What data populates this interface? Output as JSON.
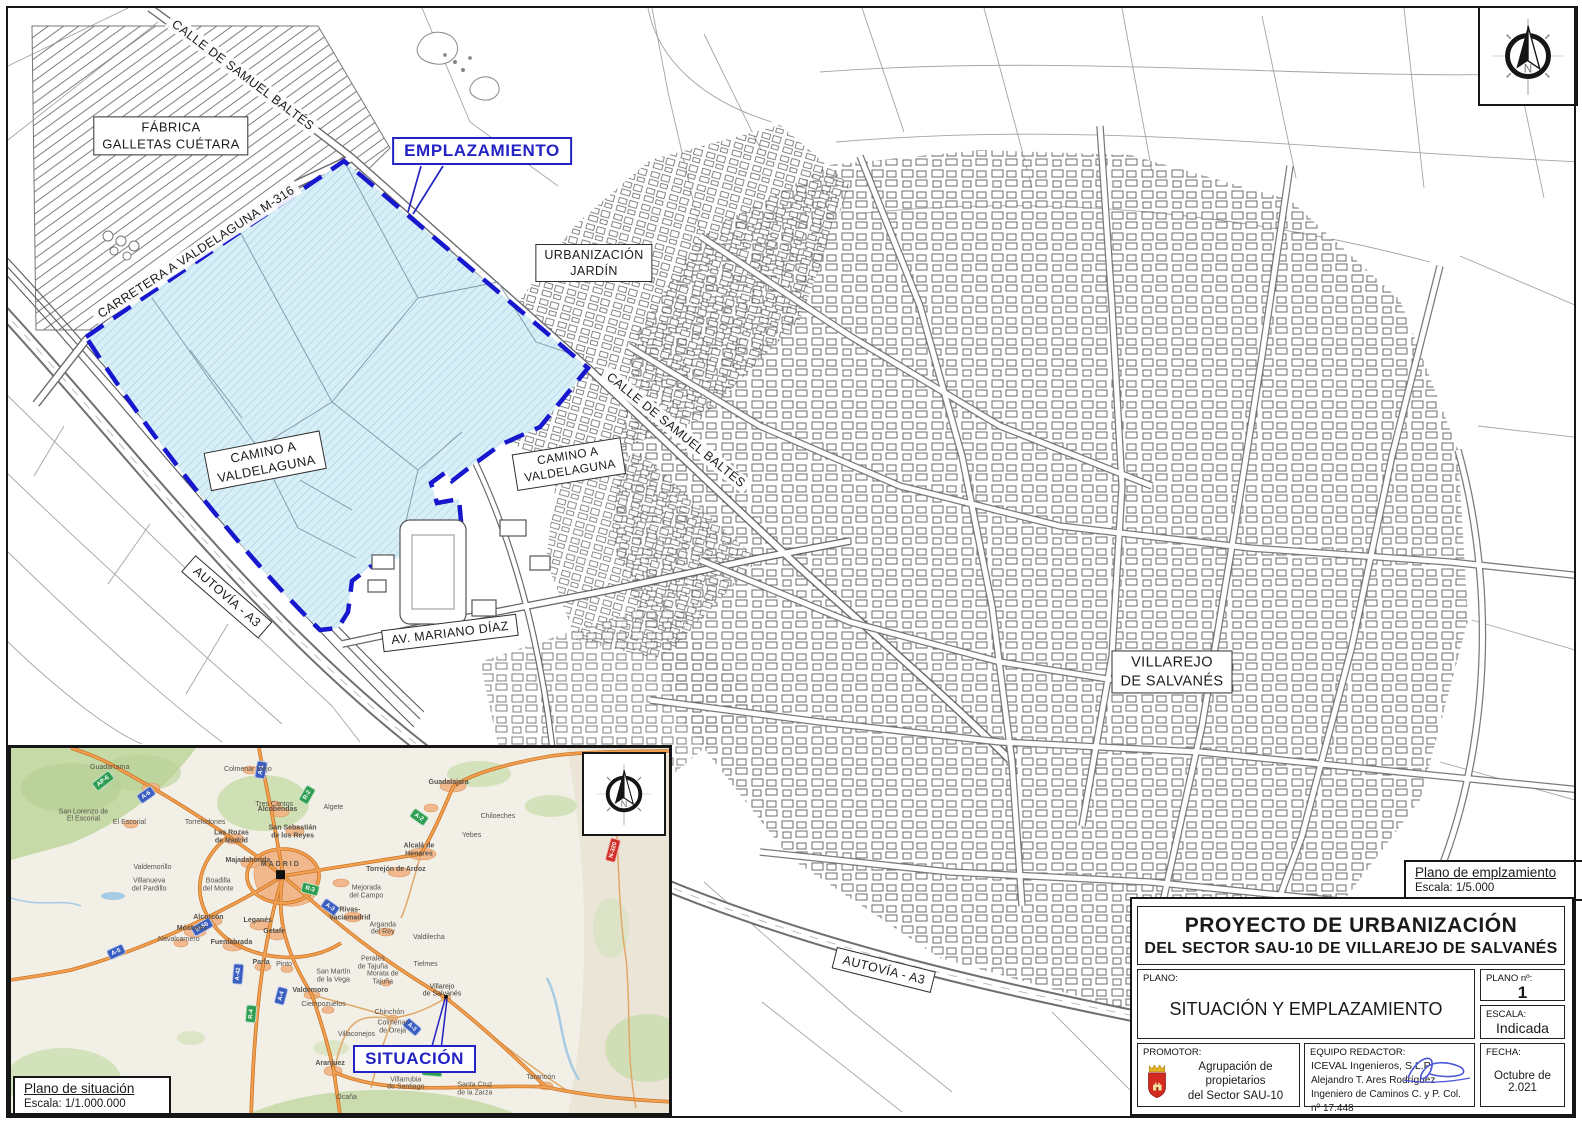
{
  "sheet": {
    "north_letter": "N",
    "emplazamiento_scale_box": {
      "title": "Plano de emplzamiento",
      "scale": "Escala: 1/5.000"
    },
    "situacion_scale_box": {
      "title": "Plano de situación",
      "scale": "Escala: 1/1.000.000"
    }
  },
  "colors": {
    "site_fill": "#d9eff7",
    "site_hatch": "#abd5e6",
    "boundary_blue": "#1717cd",
    "callout_blue": "#2323c4",
    "road_orange": "#e8903c",
    "shield_blue": "#3a5fc0",
    "shield_green": "#2f9e52",
    "shield_red": "#d03028",
    "promoter_shield_red": "#d42a20"
  },
  "main_map": {
    "emplazamiento": {
      "text": "EMPLAZAMIENTO"
    },
    "labels": [
      {
        "id": "fabrica-galletas-cuetara",
        "lines": [
          "FÁBRICA",
          "GALLETAS CUÉTARA"
        ],
        "x": 171,
        "y": 136,
        "rot": 0,
        "boxed": true,
        "fs": 13
      },
      {
        "id": "calle-samuel-baltes-top",
        "lines": [
          "CALLE DE SAMUEL BALTÉS"
        ],
        "x": 243,
        "y": 75,
        "rot": 37,
        "boxed": false,
        "fs": 12.5
      },
      {
        "id": "carretera-valdelaguna-m316",
        "lines": [
          "CARRETERA A VALDELAGUNA M-316"
        ],
        "x": 196,
        "y": 252,
        "rot": -33,
        "boxed": false,
        "fs": 12.5
      },
      {
        "id": "urbanizacion-jardin",
        "lines": [
          "URBANIZACIÓN",
          "JARDÍN"
        ],
        "x": 594,
        "y": 263,
        "rot": 0,
        "boxed": true,
        "fs": 12.5
      },
      {
        "id": "calle-samuel-baltes-mid",
        "lines": [
          "CALLE DE SAMUEL BALTÉS"
        ],
        "x": 676,
        "y": 430,
        "rot": 39,
        "boxed": false,
        "fs": 12.5
      },
      {
        "id": "camino-a-valdelaguna-left",
        "lines": [
          "CAMINO A",
          "VALDELAGUNA"
        ],
        "x": 265,
        "y": 461,
        "rot": -11,
        "boxed": true,
        "fs": 13
      },
      {
        "id": "camino-a-valdelaguna-right",
        "lines": [
          "CAMINO A",
          "VALDELAGUNA"
        ],
        "x": 569,
        "y": 464,
        "rot": -9,
        "boxed": true,
        "fs": 12
      },
      {
        "id": "autovia-a3-left",
        "lines": [
          "AUTOVÍA - A3"
        ],
        "x": 227,
        "y": 597,
        "rot": 41,
        "boxed": true,
        "fs": 12.5
      },
      {
        "id": "av-mariano-diaz",
        "lines": [
          "AV. MARIANO DÍAZ"
        ],
        "x": 450,
        "y": 633,
        "rot": -7,
        "boxed": true,
        "fs": 12.5
      },
      {
        "id": "villarejo-de-salvanes",
        "lines": [
          "VILLAREJO",
          "DE SALVANÉS"
        ],
        "x": 1172,
        "y": 672,
        "rot": 0,
        "boxed": true,
        "fs": 14.5
      },
      {
        "id": "autovia-a3-bottom",
        "lines": [
          "AUTOVÍA - A3"
        ],
        "x": 884,
        "y": 970,
        "rot": 14,
        "boxed": true,
        "fs": 12.5
      }
    ]
  },
  "inset": {
    "situacion": {
      "text": "SITUACIÓN"
    },
    "towns": [
      {
        "n": "MADRID",
        "x": 41,
        "y": 33.5,
        "c": "capital"
      },
      {
        "n": "Guadalajara",
        "x": 66.5,
        "y": 9.5,
        "c": "city"
      },
      {
        "n": "Alcobendas",
        "x": 40.5,
        "y": 17,
        "c": "city"
      },
      {
        "n": "San Sebastián|de los Reyes",
        "x": 42.8,
        "y": 23,
        "c": "city"
      },
      {
        "n": "Las Rozas|de Madrid",
        "x": 33.5,
        "y": 24.5,
        "c": "city"
      },
      {
        "n": "Majadahonda",
        "x": 36,
        "y": 31,
        "c": "city"
      },
      {
        "n": "Alcalá de|Henares",
        "x": 62,
        "y": 28,
        "c": "city"
      },
      {
        "n": "Torrejón de Ardoz",
        "x": 58.5,
        "y": 33.5,
        "c": "city"
      },
      {
        "n": "Rivas-|Vaciamadrid",
        "x": 51.5,
        "y": 45.5,
        "c": "city"
      },
      {
        "n": "Alcorcón",
        "x": 30,
        "y": 46.5,
        "c": "city"
      },
      {
        "n": "Leganés",
        "x": 37.5,
        "y": 47.5,
        "c": "city"
      },
      {
        "n": "Móstoles",
        "x": 27.5,
        "y": 49.5,
        "c": "city"
      },
      {
        "n": "Getafe",
        "x": 40,
        "y": 50.5,
        "c": "city"
      },
      {
        "n": "Fuenlabrada",
        "x": 33.5,
        "y": 53.5,
        "c": "city"
      },
      {
        "n": "Parla",
        "x": 38,
        "y": 59,
        "c": "city"
      },
      {
        "n": "Valdemoro",
        "x": 45.5,
        "y": 66.5,
        "c": "city"
      },
      {
        "n": "Aranjuez",
        "x": 48.5,
        "y": 86.5,
        "c": "city"
      },
      {
        "n": "Guadarrama",
        "x": 15,
        "y": 5.5,
        "c": "town"
      },
      {
        "n": "Colmenar Viejo",
        "x": 36,
        "y": 6,
        "c": "town"
      },
      {
        "n": "Tres Cantos",
        "x": 40,
        "y": 15.5,
        "c": "town"
      },
      {
        "n": "Torrelodones",
        "x": 29.5,
        "y": 20.5,
        "c": "town"
      },
      {
        "n": "El Escorial",
        "x": 18,
        "y": 20.5,
        "c": "town"
      },
      {
        "n": "San Lorenzo de|El Escorial",
        "x": 11,
        "y": 18.5,
        "c": "town"
      },
      {
        "n": "Valdemorillo",
        "x": 21.5,
        "y": 33,
        "c": "town"
      },
      {
        "n": "Villanueva|del Pardillo",
        "x": 21,
        "y": 37.5,
        "c": "town"
      },
      {
        "n": "Boadilla|del Monte",
        "x": 31.5,
        "y": 37.5,
        "c": "town"
      },
      {
        "n": "Navalcarnero",
        "x": 25.5,
        "y": 52.5,
        "c": "town"
      },
      {
        "n": "Pinto",
        "x": 41.5,
        "y": 59.5,
        "c": "town"
      },
      {
        "n": "Ciempozuelos",
        "x": 47.5,
        "y": 70.5,
        "c": "town"
      },
      {
        "n": "San Martín|de la Vega",
        "x": 49,
        "y": 62.5,
        "c": "town"
      },
      {
        "n": "Morata de|Tajuña",
        "x": 56.5,
        "y": 63,
        "c": "town"
      },
      {
        "n": "Perales|de Tajuña",
        "x": 55,
        "y": 59,
        "c": "town"
      },
      {
        "n": "Tielmes",
        "x": 63,
        "y": 59.5,
        "c": "town"
      },
      {
        "n": "Valdilecha",
        "x": 63.5,
        "y": 52,
        "c": "town"
      },
      {
        "n": "Arganda|del Rey",
        "x": 56.5,
        "y": 49.5,
        "c": "town"
      },
      {
        "n": "Mejorada|del Campo",
        "x": 54,
        "y": 39.5,
        "c": "town"
      },
      {
        "n": "Algete",
        "x": 49,
        "y": 16.5,
        "c": "town"
      },
      {
        "n": "Yebes",
        "x": 70,
        "y": 24,
        "c": "town"
      },
      {
        "n": "Chiloeches",
        "x": 74,
        "y": 19,
        "c": "town"
      },
      {
        "n": "Chinchón",
        "x": 57.5,
        "y": 72.5,
        "c": "town"
      },
      {
        "n": "Colmenar|de Oreja",
        "x": 58,
        "y": 76.5,
        "c": "town"
      },
      {
        "n": "Villaconejos",
        "x": 52.5,
        "y": 78.5,
        "c": "town"
      },
      {
        "n": "Ocaña",
        "x": 51,
        "y": 96,
        "c": "town"
      },
      {
        "n": "Villarrubia|de Santiago",
        "x": 60,
        "y": 92,
        "c": "town"
      },
      {
        "n": "Santa Cruz|de la Zarza",
        "x": 70.5,
        "y": 93.5,
        "c": "town"
      },
      {
        "n": "Tarancón",
        "x": 80.5,
        "y": 90.5,
        "c": "town"
      },
      {
        "n": "Villarejo|de Salvanés",
        "x": 65.5,
        "y": 66.5,
        "c": "target"
      }
    ],
    "shields": [
      {
        "t": "AP-6",
        "x": 14,
        "y": 9,
        "r": -38,
        "c": "g"
      },
      {
        "t": "A-6",
        "x": 20.5,
        "y": 13,
        "r": -35,
        "c": "b"
      },
      {
        "t": "A-1",
        "x": 38,
        "y": 6,
        "r": -80,
        "c": "b"
      },
      {
        "t": "R-2",
        "x": 45,
        "y": 13,
        "r": -60,
        "c": "g"
      },
      {
        "t": "A-2",
        "x": 62,
        "y": 19,
        "r": 35,
        "c": "g"
      },
      {
        "t": "N-320",
        "x": 91.5,
        "y": 28,
        "r": -75,
        "c": "r"
      },
      {
        "t": "M-50",
        "x": 29,
        "y": 49,
        "r": -30,
        "c": "b"
      },
      {
        "t": "A-5",
        "x": 16,
        "y": 56,
        "r": -25,
        "c": "b"
      },
      {
        "t": "A-42",
        "x": 34.5,
        "y": 62,
        "r": -85,
        "c": "b"
      },
      {
        "t": "A-4",
        "x": 41,
        "y": 68,
        "r": -75,
        "c": "b"
      },
      {
        "t": "R-4",
        "x": 36.5,
        "y": 73,
        "r": -85,
        "c": "g"
      },
      {
        "t": "R-3",
        "x": 45.5,
        "y": 38.5,
        "r": 15,
        "c": "g"
      },
      {
        "t": "A-3",
        "x": 48.5,
        "y": 43.5,
        "r": 35,
        "c": "b"
      },
      {
        "t": "A-3",
        "x": 61,
        "y": 76.5,
        "r": 40,
        "c": "b"
      },
      {
        "t": "A-40",
        "x": 64,
        "y": 88.5,
        "r": 5,
        "c": "g"
      }
    ]
  },
  "title_block": {
    "title1": "PROYECTO DE URBANIZACIÓN",
    "title2": "DEL SECTOR  SAU-10 DE VILLAREJO DE SALVANÉS",
    "plano_label": "PLANO:",
    "plano_value": "SITUACIÓN Y EMPLAZAMIENTO",
    "plano_num_label": "PLANO  nº:",
    "plano_num_value": "1",
    "escala_label": "ESCALA:",
    "escala_value": "Indicada",
    "promotor_label": "PROMOTOR:",
    "promotor_line1": "Agrupación de propietarios",
    "promotor_line2": "del Sector SAU-10",
    "equipo_label": "EQUIPO REDACTOR:",
    "equipo_line1": "ICEVAL Ingenieros, S.L.P.",
    "equipo_line2": "Alejandro T. Ares Rodríguez",
    "equipo_line3": "Ingeniero de Caminos C. y P. Col. nº 17.448",
    "fecha_label": "FECHA:",
    "fecha_value": "Octubre de 2.021"
  }
}
